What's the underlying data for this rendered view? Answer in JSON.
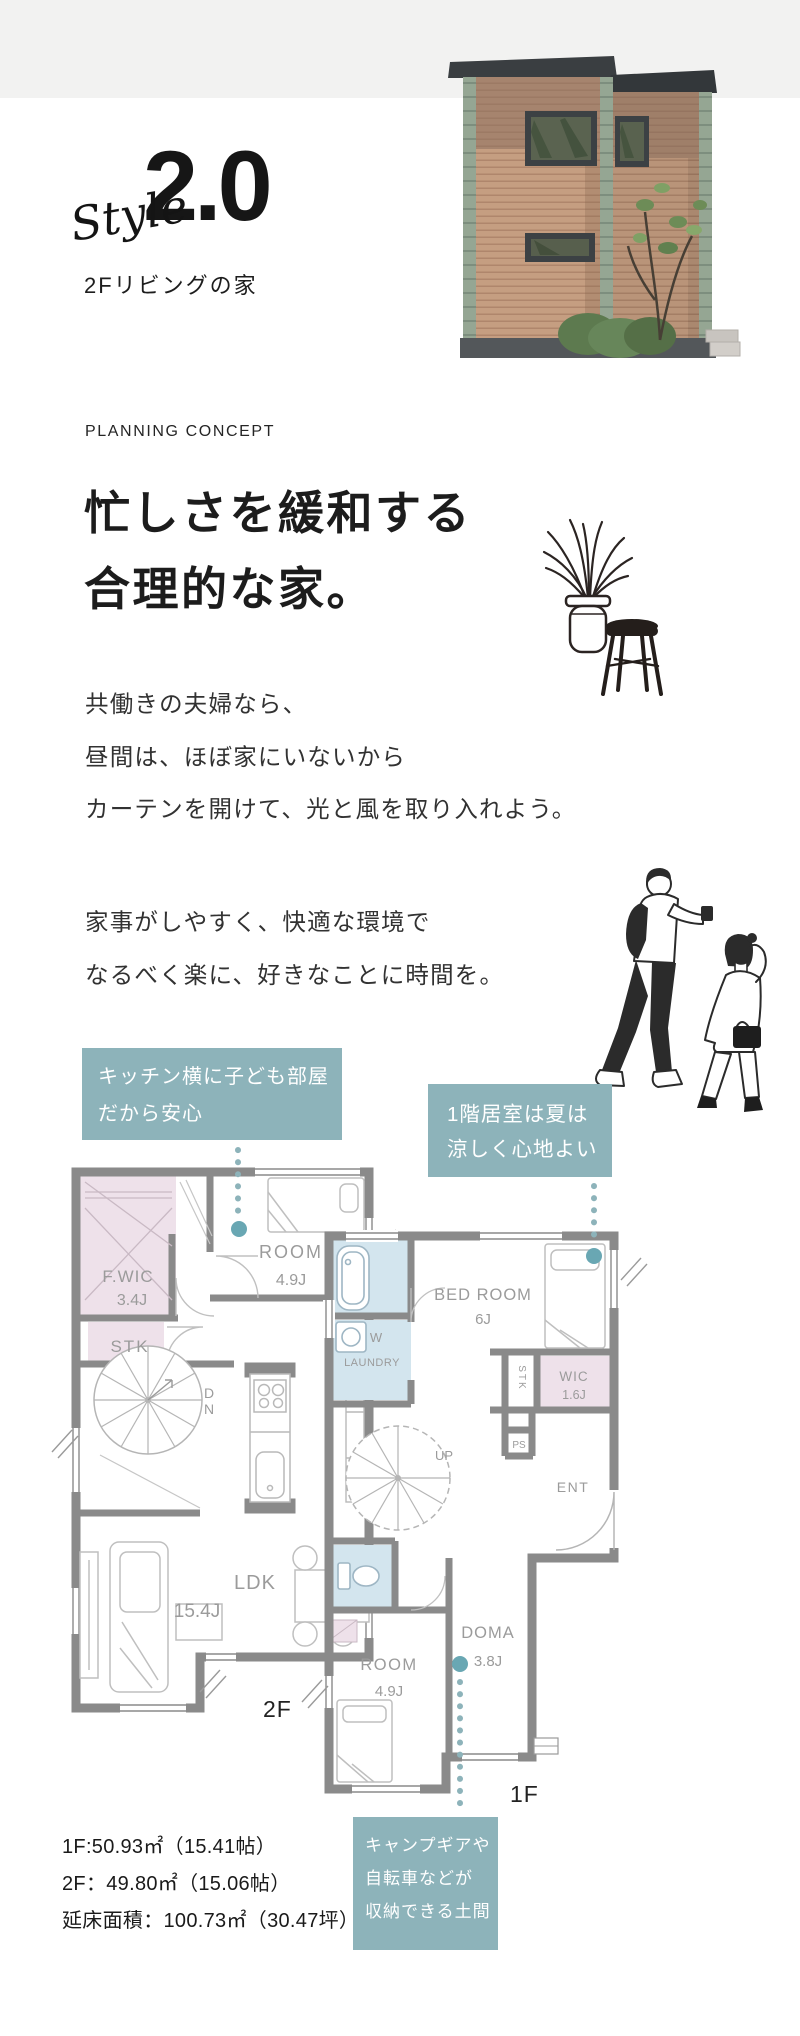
{
  "header": {
    "style_script": "Style",
    "version": "2.0",
    "subtitle": "2Fリビングの家"
  },
  "concept": {
    "eyebrow": "PLANNING CONCEPT",
    "heading_line1": "忙しさを緩和する",
    "heading_line2": "合理的な家。",
    "paragraph1": [
      "共働きの夫婦なら、",
      "昼間は、ほぼ家にいないから",
      "カーテンを開けて、光と風を取り入れよう。"
    ],
    "paragraph2": [
      "家事がしやすく、快適な環境で",
      "なるべく楽に、好きなことに時間を。"
    ]
  },
  "callouts": {
    "kitchen": {
      "line1": "キッチン横に子ども部屋",
      "line2": "だから安心"
    },
    "first_floor": {
      "line1": "1階居室は夏は",
      "line2": "涼しく心地よい"
    },
    "doma": {
      "line1": "キャンプギアや",
      "line2": "自転車などが",
      "line3": "収納できる土間"
    }
  },
  "plan2f": {
    "floor_label": "2F",
    "rooms": {
      "fwic": "F.WIC",
      "fwic_size": "3.4J",
      "stk": "STK",
      "room": "ROOM",
      "room_size": "4.9J",
      "dn_d": "D",
      "dn_n": "N",
      "ldk": "LDK",
      "ldk_size": "15.4J"
    }
  },
  "plan1f": {
    "floor_label": "1F",
    "rooms": {
      "bedroom": "BED ROOM",
      "bedroom_size": "6J",
      "w": "W",
      "laundry": "LAUNDRY",
      "wic": "WIC",
      "wic_size": "1.6J",
      "stk": "STK",
      "ps": "PS",
      "up": "UP",
      "ent": "ENT",
      "room": "ROOM",
      "room_size": "4.9J",
      "doma": "DOMA",
      "doma_size": "3.8J"
    }
  },
  "areas": {
    "line1": "1F:50.93㎡（15.41帖）",
    "line2": "2F：49.80㎡（15.06帖）",
    "line3": "延床面積：100.73㎡（30.47坪）"
  },
  "colors": {
    "accent_teal": "#8db3ba",
    "leader_dot_teal": "#69a7b3",
    "wall_gray": "#8a8a8a",
    "room_pink": "#eee1ea",
    "room_blue": "#d3e5ee",
    "top_band": "#f2f2f1"
  }
}
